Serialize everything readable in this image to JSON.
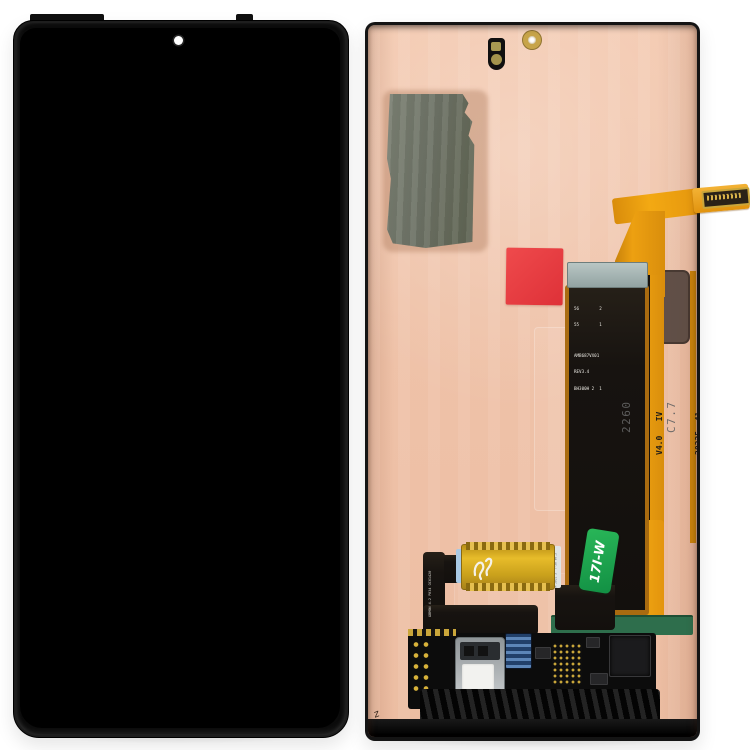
{
  "scene": {
    "description": "Product photo: phone OLED screen and digitizer full assembly, front (black screen) and back (copper panel with flex cables)",
    "background_color": "#ffffff"
  },
  "front_assembly": {
    "frame_color": "#0b0b0b",
    "screen_color": "#000000",
    "camera_hole_color": "#ffffff"
  },
  "back_assembly": {
    "panel_color": "#efc2a8",
    "graphite_patch_color": "#6e7366",
    "red_sticker_color": "#e23c40",
    "stiffener_color": "#9fb0ad",
    "orange_flex_color": "#eda011",
    "green_pcb_color": "#2e6e4c",
    "main_flex": {
      "print_line1": "56        2",
      "print_line2": "55        1",
      "print_line3": "AMB687VX01",
      "print_line4": "REV3.4",
      "print_line5": "BH300H 2  1",
      "stamp_line1": "2260",
      "stamp_line2": "C7.7"
    },
    "orange_flex": {
      "version_line1": "V4.0   IV",
      "version_line2": "20235  41"
    },
    "green_sticker": {
      "text": "17I-W",
      "color": "#1ea34d"
    },
    "small_flex": {
      "ribbon_print": "GBM9N 4-2 P034 OC61420",
      "pad_side_print": "M 2021 3  T-3A V0.3"
    },
    "handwritten_mark": "z"
  }
}
